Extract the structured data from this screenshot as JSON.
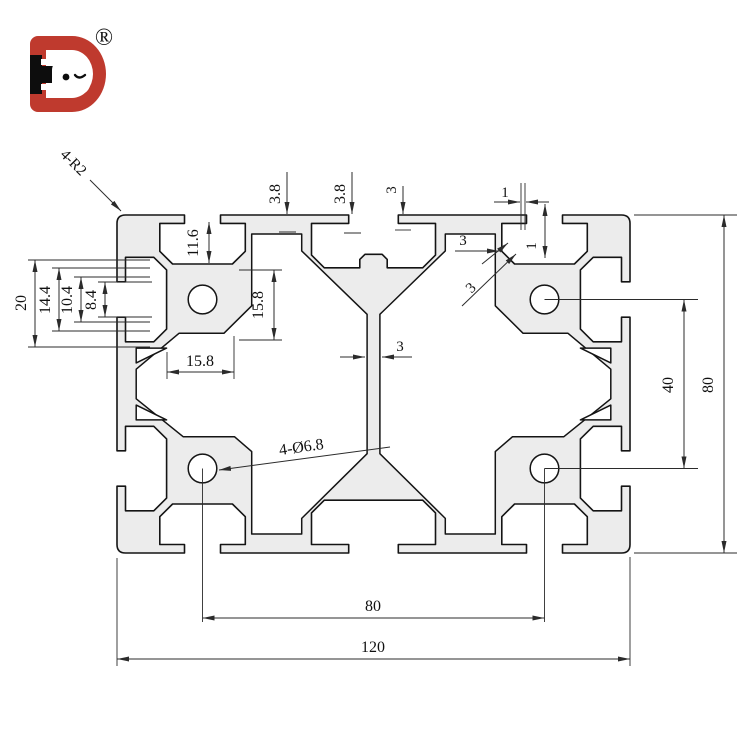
{
  "page": {
    "background": "#ffffff"
  },
  "logo": {
    "brand_letters": "HD",
    "registered_mark": "®",
    "colors": {
      "red": "#bf3a2e",
      "black": "#0d0d0d"
    }
  },
  "drawing": {
    "subject": "aluminum t-slot extrusion profile cross-section 80x120",
    "body_fill": "#ececec",
    "outline_color": "#141414",
    "dim_color": "#2b2b2b",
    "dims": {
      "corner_radius": "4-R2",
      "top_step_left": "3.8",
      "top_step_center": "3.8",
      "top_step_right": "3",
      "top_gap_width": "1",
      "top_gap_depth": "1",
      "lip_wall": "3",
      "flank_wall": "3",
      "slot_depth": "11.6",
      "core_width": "15.8",
      "core_height": "15.8",
      "slot_outer_width": "20",
      "slot_cavity_width": "14.4",
      "slot_throat_width": "10.4",
      "slot_opening_width": "8.4",
      "hole_callout": "4-Ø6.8",
      "web_thickness": "3",
      "hole_pitch_vertical": "40",
      "profile_height": "80",
      "hole_pitch_horizontal": "80",
      "profile_width": "120"
    }
  }
}
